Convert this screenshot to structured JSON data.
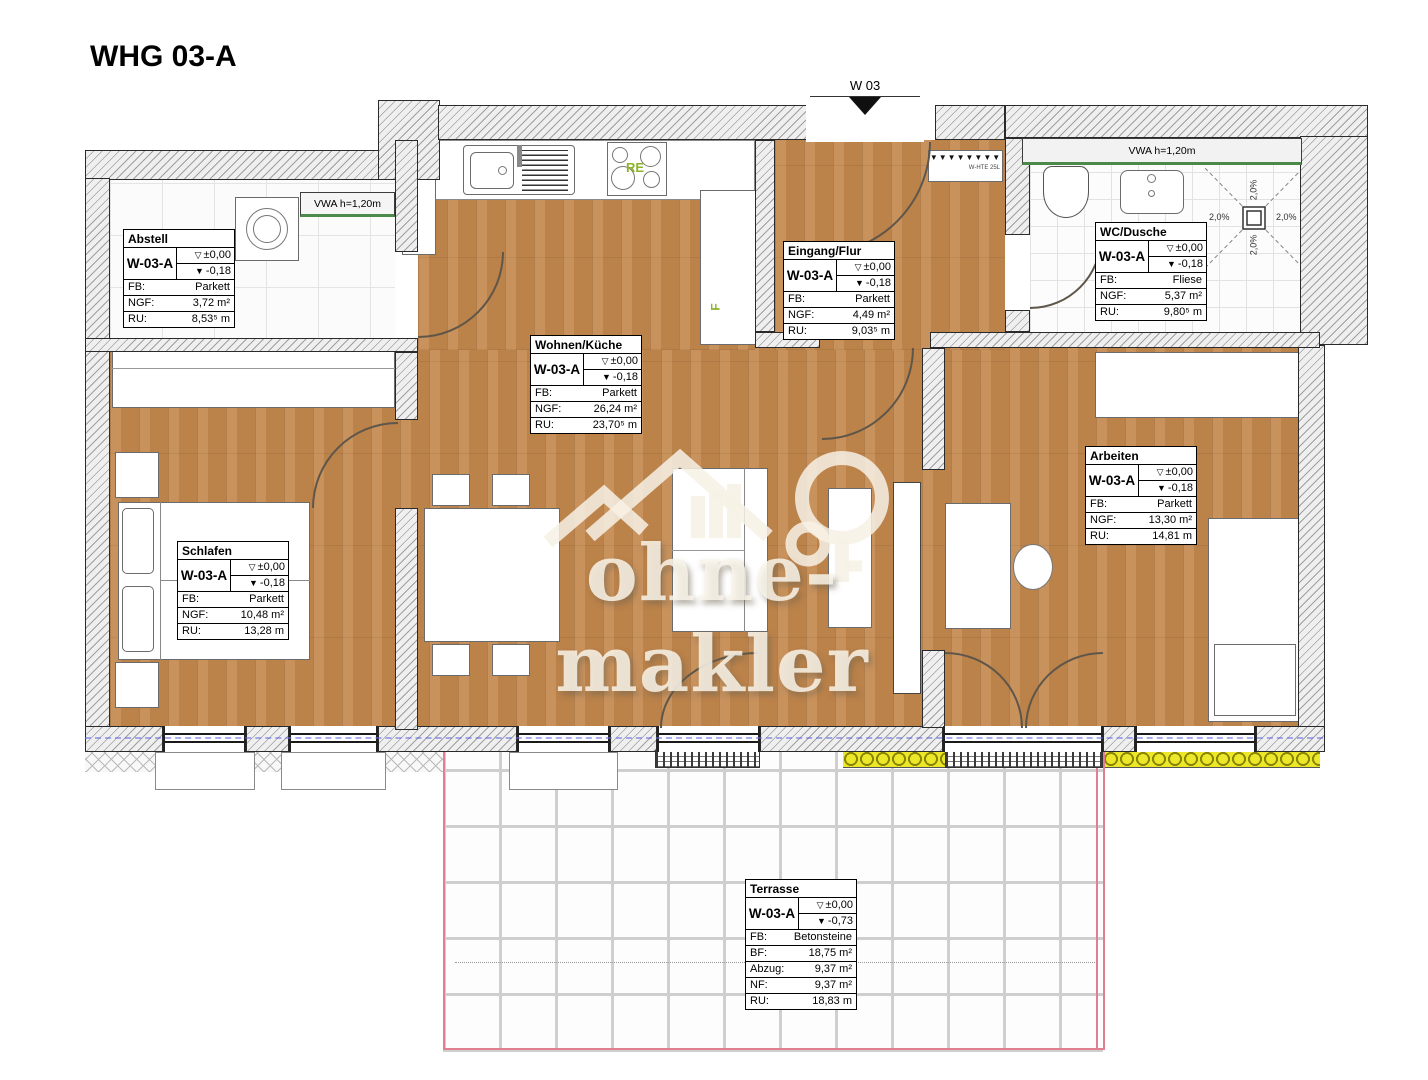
{
  "title": "WHG 03-A",
  "entrance_label": "W 03",
  "watermark": "ohne-makler",
  "annotations": {
    "vwa_left": "VWA h=1,20m",
    "vwa_right": "VWA h=1,20m",
    "stove_code": "RE",
    "fridge_code": "F",
    "heater_code": "W-HTE 25L",
    "heater_symbols": "▼▼▼▼▼▼▼▼",
    "slope": "2,0%"
  },
  "rooms": [
    {
      "name": "Abstell",
      "unit": "W-03-A",
      "upper_symbol": "▽",
      "upper": "±0,00",
      "lower_symbol": "▼",
      "lower": "-0,18",
      "rows": [
        {
          "k": "FB:",
          "v": "Parkett"
        },
        {
          "k": "NGF:",
          "v": "3,72 m²"
        },
        {
          "k": "RU:",
          "v": "8,53⁵ m"
        }
      ]
    },
    {
      "name": "Eingang/Flur",
      "unit": "W-03-A",
      "upper_symbol": "▽",
      "upper": "±0,00",
      "lower_symbol": "▼",
      "lower": "-0,18",
      "rows": [
        {
          "k": "FB:",
          "v": "Parkett"
        },
        {
          "k": "NGF:",
          "v": "4,49 m²"
        },
        {
          "k": "RU:",
          "v": "9,03⁵ m"
        }
      ]
    },
    {
      "name": "WC/Dusche",
      "unit": "W-03-A",
      "upper_symbol": "▽",
      "upper": "±0,00",
      "lower_symbol": "▼",
      "lower": "-0,18",
      "rows": [
        {
          "k": "FB:",
          "v": "Fliese"
        },
        {
          "k": "NGF:",
          "v": "5,37 m²"
        },
        {
          "k": "RU:",
          "v": "9,80⁵ m"
        }
      ]
    },
    {
      "name": "Wohnen/Küche",
      "unit": "W-03-A",
      "upper_symbol": "▽",
      "upper": "±0,00",
      "lower_symbol": "▼",
      "lower": "-0,18",
      "rows": [
        {
          "k": "FB:",
          "v": "Parkett"
        },
        {
          "k": "NGF:",
          "v": "26,24 m²"
        },
        {
          "k": "RU:",
          "v": "23,70⁵ m"
        }
      ]
    },
    {
      "name": "Schlafen",
      "unit": "W-03-A",
      "upper_symbol": "▽",
      "upper": "±0,00",
      "lower_symbol": "▼",
      "lower": "-0,18",
      "rows": [
        {
          "k": "FB:",
          "v": "Parkett"
        },
        {
          "k": "NGF:",
          "v": "10,48 m²"
        },
        {
          "k": "RU:",
          "v": "13,28 m"
        }
      ]
    },
    {
      "name": "Arbeiten",
      "unit": "W-03-A",
      "upper_symbol": "▽",
      "upper": "±0,00",
      "lower_symbol": "▼",
      "lower": "-0,18",
      "rows": [
        {
          "k": "FB:",
          "v": "Parkett"
        },
        {
          "k": "NGF:",
          "v": "13,30 m²"
        },
        {
          "k": "RU:",
          "v": "14,81 m"
        }
      ]
    },
    {
      "name": "Terrasse",
      "unit": "W-03-A",
      "upper_symbol": "▽",
      "upper": "±0,00",
      "lower_symbol": "▼",
      "lower": "-0,73",
      "rows": [
        {
          "k": "FB:",
          "v": "Betonsteine"
        },
        {
          "k": "BF:",
          "v": "18,75 m²"
        },
        {
          "k": "Abzug:",
          "v": "9,37 m²"
        },
        {
          "k": "NF:",
          "v": "9,37 m²"
        },
        {
          "k": "RU:",
          "v": "18,83 m"
        }
      ]
    }
  ]
}
